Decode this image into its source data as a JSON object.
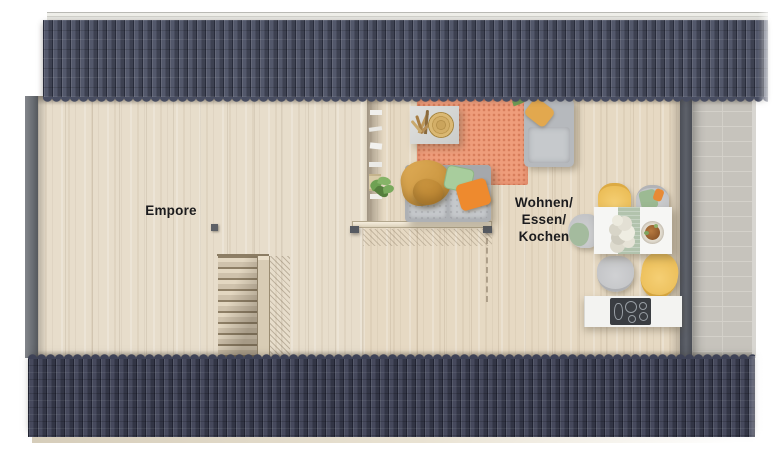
{
  "floorplan": {
    "labels": {
      "empore": "Empore",
      "living_lines": [
        "Wohnen/",
        "Essen/",
        "Kochen"
      ]
    },
    "colors": {
      "roof_top": "#4a4f63",
      "roof_bottom": "#3e4256",
      "gutter": "#e4e4df",
      "wood_floor_empore": "#e7ddcb",
      "wood_floor_living": "#e6d9c3",
      "wall_left": "#6b6f75",
      "wall_right": "#5d616a",
      "balcony_tile": "#c6c3bc",
      "rug": "#ef9d7b",
      "sofa": "#aeb1b5",
      "blanket_mustard": "#d7a24e",
      "pillow_green": "#a8cd9d",
      "pillow_orange": "#ee8a2e",
      "chair_yellow": "#f0c566",
      "chair_grey": "#c7c8ca",
      "table_runner": "#b2c3ad",
      "counter": "#f3f3f1",
      "cooktop": "#3a3d42",
      "stair_tread": "#d8ccb5",
      "label_text": "#1c1c1e"
    }
  }
}
